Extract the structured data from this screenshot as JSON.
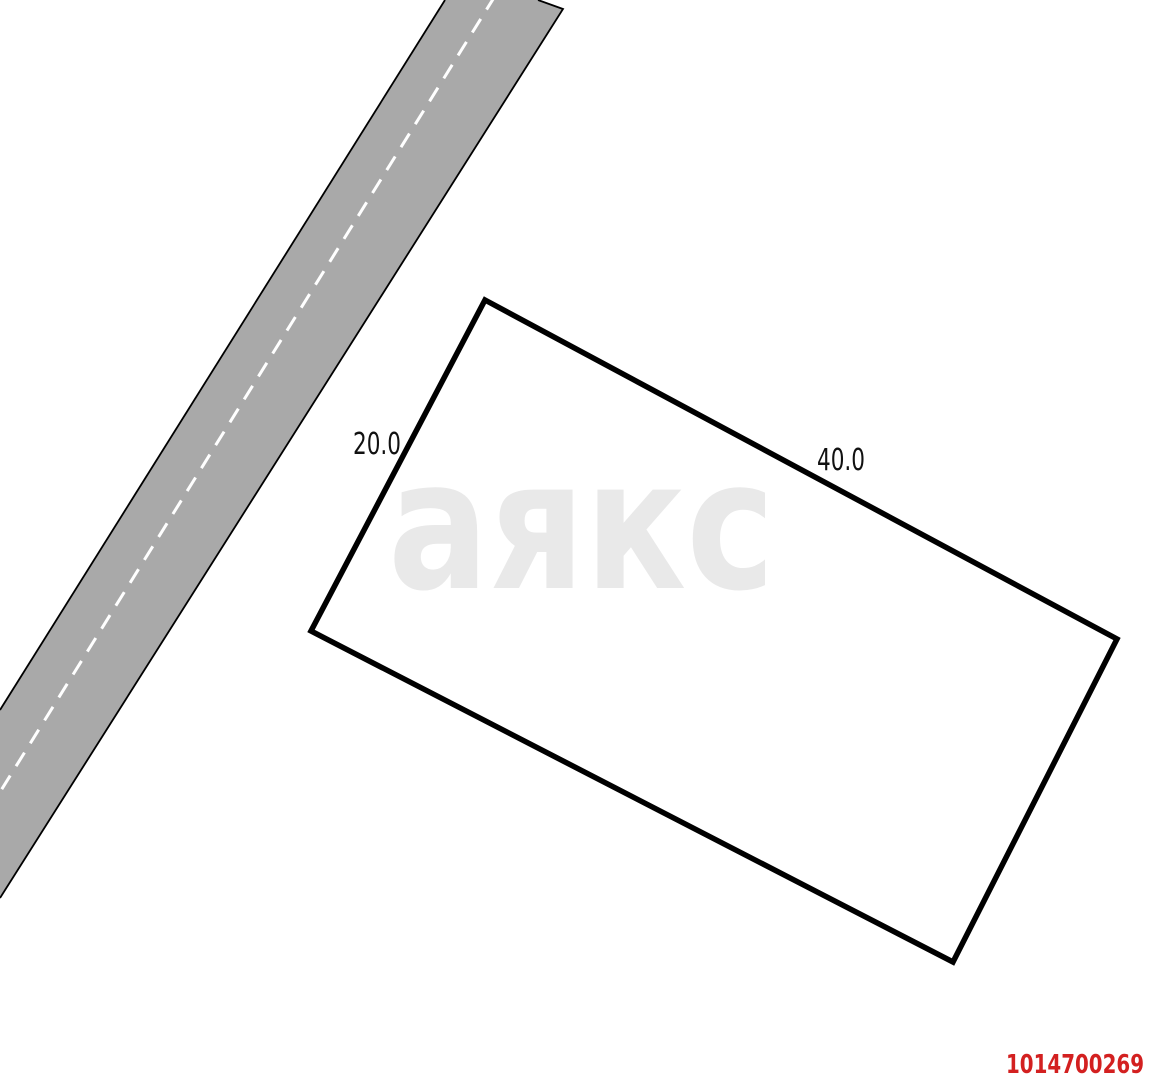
{
  "diagram": {
    "type": "land-plot-site-plan",
    "watermark_text": "аякс",
    "listing_id": "1014700269",
    "plot": {
      "short_side_label": "20.0",
      "long_side_label": "40.0"
    },
    "colors": {
      "background": "#ffffff",
      "road_fill": "#a9a9a9",
      "road_edge": "#000000",
      "road_centerline": "#ffffff",
      "plot_outline": "#000000",
      "plot_fill": "#ffffff",
      "dimension_text": "#111111",
      "watermark": "#e9e9e9",
      "listing_id_color": "#d32020"
    }
  }
}
